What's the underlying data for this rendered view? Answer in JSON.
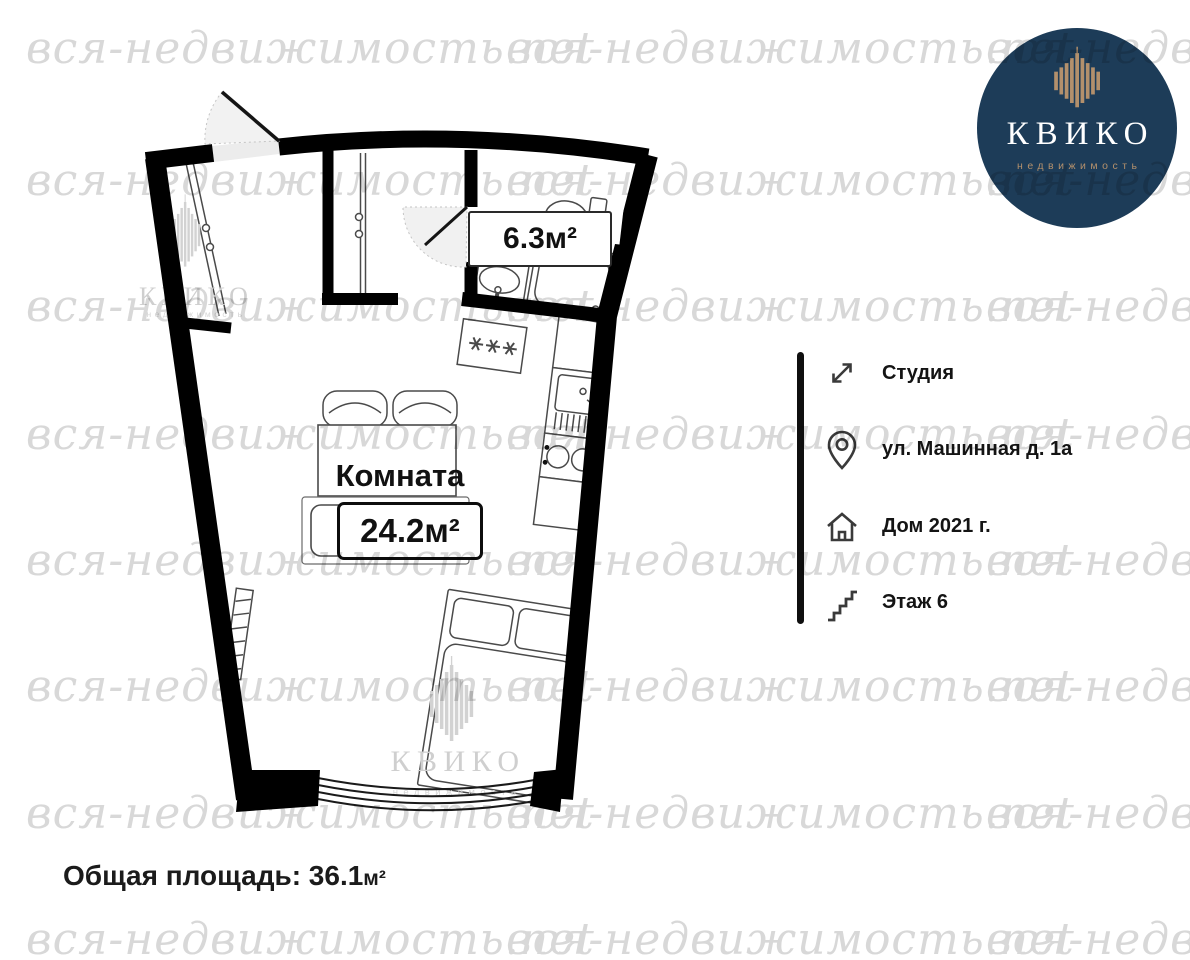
{
  "watermark": {
    "text": "вся-недвижимость.net"
  },
  "logo": {
    "name": "КВИКО",
    "subtitle": "недвижимость"
  },
  "floor_plan": {
    "room_label": "Комната",
    "room_area": "24.2м²",
    "bathroom_area": "6.3м²"
  },
  "info_panel": {
    "items": [
      {
        "icon": "expand-arrows-icon",
        "label": "Студия"
      },
      {
        "icon": "location-pin-icon",
        "label": "ул. Машинная д. 1а"
      },
      {
        "icon": "house-icon",
        "label": "Дом 2021 г."
      },
      {
        "icon": "stairs-icon",
        "label": "Этаж 6"
      }
    ]
  },
  "footer": {
    "total_area_text": "Общая площадь: 36.1",
    "total_area_unit": "м²"
  },
  "colors": {
    "logo_navy": "#1d3c58",
    "logo_gold": "#b3906c",
    "watermark": "#d8d8d8",
    "wall": "#000000"
  }
}
